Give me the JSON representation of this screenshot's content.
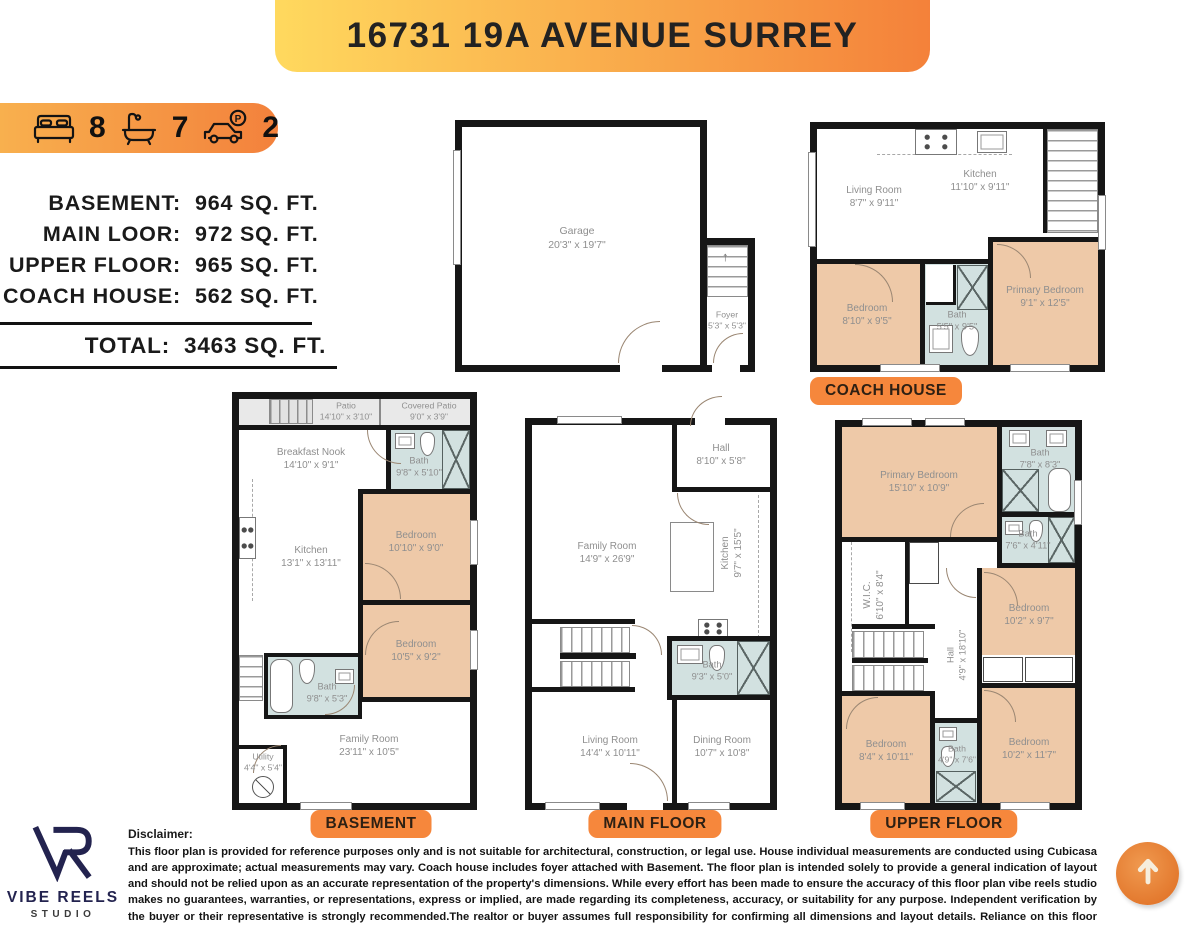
{
  "header": {
    "title": "16731 19A AVENUE SURREY"
  },
  "stats": {
    "beds": "8",
    "baths": "7",
    "parking": "2"
  },
  "area_summary": {
    "rows": [
      {
        "label": "BASEMENT:",
        "value": "964 SQ. FT."
      },
      {
        "label": "MAIN LOOR:",
        "value": "972 SQ. FT."
      },
      {
        "label": "UPPER FLOOR:",
        "value": "965 SQ. FT."
      },
      {
        "label": "COACH HOUSE:",
        "value": "562 SQ. FT."
      }
    ],
    "total_label": "TOTAL:",
    "total_value": "3463 SQ. FT."
  },
  "plans": {
    "garage": {
      "rooms": {
        "garage": {
          "name": "Garage",
          "dims": "20'3\" x 19'7\""
        },
        "foyer": {
          "name": "Foyer",
          "dims": "5'3\" x 5'3\""
        }
      }
    },
    "coach": {
      "label": "COACH HOUSE",
      "rooms": {
        "living": {
          "name": "Living Room",
          "dims": "8'7\" x 9'11\""
        },
        "kitchen": {
          "name": "Kitchen",
          "dims": "11'10\" x 9'11\""
        },
        "bedroom": {
          "name": "Bedroom",
          "dims": "8'10\" x 9'5\""
        },
        "bath": {
          "name": "Bath",
          "dims": "5'5\" x 9'5\""
        },
        "primary": {
          "name": "Primary Bedroom",
          "dims": "9'1\" x 12'5\""
        }
      }
    },
    "basement": {
      "label": "BASEMENT",
      "rooms": {
        "patio": {
          "name": "Patio",
          "dims": "14'10\" x 3'10\""
        },
        "covered_patio": {
          "name": "Covered Patio",
          "dims": "9'0\" x 3'9\""
        },
        "breakfast": {
          "name": "Breakfast Nook",
          "dims": "14'10\" x 9'1\""
        },
        "bath1": {
          "name": "Bath",
          "dims": "9'8\" x 5'10\""
        },
        "bedroom1": {
          "name": "Bedroom",
          "dims": "10'10\" x 9'0\""
        },
        "kitchen": {
          "name": "Kitchen",
          "dims": "13'1\" x 13'11\""
        },
        "bedroom2": {
          "name": "Bedroom",
          "dims": "10'5\" x 9'2\""
        },
        "bath2": {
          "name": "Bath",
          "dims": "9'8\" x 5'3\""
        },
        "family": {
          "name": "Family Room",
          "dims": "23'11\" x 10'5\""
        },
        "utility": {
          "name": "Utility",
          "dims": "4'4\" x 5'4\""
        }
      }
    },
    "main": {
      "label": "MAIN FLOOR",
      "rooms": {
        "hall": {
          "name": "Hall",
          "dims": "8'10\" x 5'8\""
        },
        "family": {
          "name": "Family Room",
          "dims": "14'9\" x 26'9\""
        },
        "kitchen": {
          "name": "Kitchen",
          "dims": "9'7\" x 15'5\""
        },
        "bath": {
          "name": "Bath",
          "dims": "9'3\" x 5'0\""
        },
        "living": {
          "name": "Living Room",
          "dims": "14'4\" x 10'11\""
        },
        "dining": {
          "name": "Dining Room",
          "dims": "10'7\" x 10'8\""
        }
      }
    },
    "upper": {
      "label": "UPPER FLOOR",
      "rooms": {
        "primary": {
          "name": "Primary Bedroom",
          "dims": "15'10\" x 10'9\""
        },
        "bath1": {
          "name": "Bath",
          "dims": "7'8\" x 8'3\""
        },
        "bath2": {
          "name": "Bath",
          "dims": "7'6\" x 4'11\""
        },
        "wic": {
          "name": "W.I.C.",
          "dims": "6'10\" x 8'4\""
        },
        "bedroom1": {
          "name": "Bedroom",
          "dims": "10'2\" x 9'7\""
        },
        "hall": {
          "name": "Hall",
          "dims": "4'9\" x 18'10\""
        },
        "bedroom2": {
          "name": "Bedroom",
          "dims": "8'4\" x 10'11\""
        },
        "bath3": {
          "name": "Bath",
          "dims": "4'9\" x 7'6\""
        },
        "bedroom3": {
          "name": "Bedroom",
          "dims": "10'2\" x 11'7\""
        }
      }
    }
  },
  "logo": {
    "brand": "VIBE REELS",
    "sub": "STUDIO"
  },
  "disclaimer": {
    "heading": "Disclaimer:",
    "body": "This floor plan is provided for reference purposes only and is not suitable for architectural, construction, or legal use. House individual measurements are conducted using Cubicasa and are approximate; actual measurements may vary. Coach house includes foyer attached with Basement. The floor plan is intended solely to provide a general indication of layout and should not be relied upon as an accurate representation of the property's dimensions. While every effort has been made to ensure the accuracy of this floor plan vibe reels studio makes no guarantees, warranties, or representations, express or implied, are made regarding its completeness, accuracy, or suitability for any purpose. Independent verification by the buyer or their representative is strongly recommended.The realtor or buyer assumes full responsibility for confirming all dimensions and layout details. Reliance on this floor plan is solely at the discretion and judgment of the client."
  },
  "colors": {
    "banner_gradient_left": "#ffd95e",
    "banner_gradient_right": "#f4813a",
    "accent_orange": "#f6873c",
    "bedroom_fill": "#eec9a8",
    "bath_fill": "#d2e1e0",
    "patio_fill": "#e9e9e9",
    "wall": "#161616",
    "logo_navy": "#23234f"
  }
}
